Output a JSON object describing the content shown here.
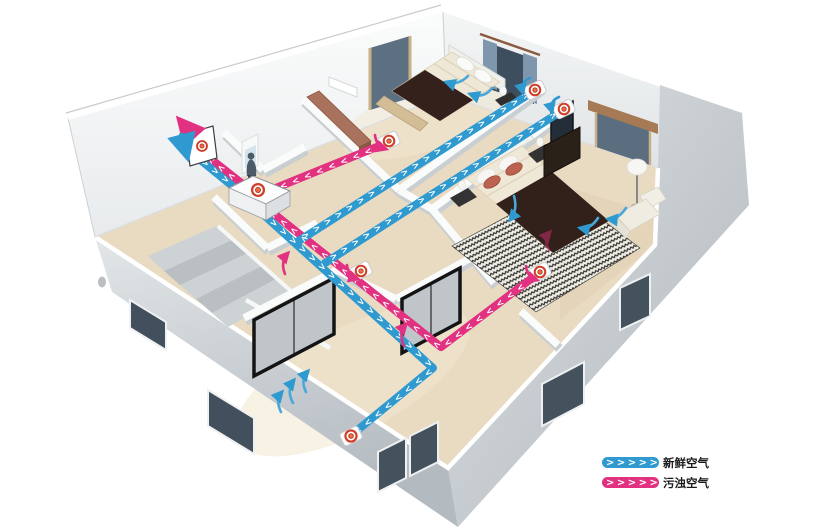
{
  "legend": {
    "items": [
      {
        "id": "fresh-air",
        "label": "新鲜空气",
        "color": "#2f9ad0",
        "chevrons": ">>>>>"
      },
      {
        "id": "exhaust-air",
        "label": "污浊空气",
        "color": "#e23180",
        "chevrons": ">>>>>"
      }
    ]
  },
  "colors": {
    "fresh_duct": "#2f9ad0",
    "exhaust_duct": "#e23180",
    "register_ring": "#cf3f28",
    "register_center": "#ef6c4a",
    "floor": "#e9dac2",
    "exterior_wall": "#ccd1d4",
    "interior_wall": "#fafbfb",
    "window_glass": "#44525e",
    "legend_text": "#1a1a1a"
  },
  "chevrons": {
    "c4": ">>>>",
    "c5": ">>>>>",
    "c11": ">>>>>>>>>>>",
    "c22": ">>>>>>>>>>>>>>>>>>>>>>",
    "c28": ">>>>>>>>>>>>>>>>>>>>>>>>>>>>"
  },
  "components": {
    "ventilation_unit": "heat-recovery-ventilator",
    "wall_vent": "exterior-wall-vent",
    "supply_registers": 3,
    "exhaust_registers": 3
  }
}
